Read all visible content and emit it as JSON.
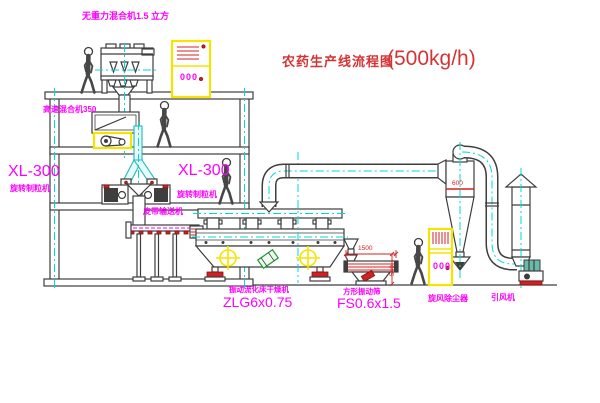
{
  "title": {
    "name": "农药生产线流程图",
    "capacity": "(500kg/h)"
  },
  "equipment_labels": {
    "gravity_free_mixer": "无重力混合机1.5 立方",
    "high_speed_mixer": "高速混合机350",
    "granulator_model": "XL-300",
    "granulator_name": "旋转制粒机",
    "belt_conveyor": "皮带输送机",
    "fluid_bed_dryer_name": "振动流化床干燥机",
    "fluid_bed_dryer_model": "ZLG6x0.75",
    "vibrating_sieve_name": "方形振动筛",
    "vibrating_sieve_model": "FS0.6x1.5",
    "cyclone_dust_collector": "旋风除尘器",
    "induced_draft_fan": "引风机"
  },
  "dimensions": {
    "cyclone_width": "600",
    "sieve_length": "1500",
    "sieve_height": "540"
  },
  "control_cabinet": {
    "display": "000"
  },
  "colors": {
    "label_magenta": "#ff00ff",
    "title_red": "#d43434",
    "line_dark": "#3e3e3e",
    "centerline_cyan": "#00d8d8",
    "accent_yellow": "#f5e400",
    "accent_red": "#cc2222",
    "accent_green": "#1f9a3a"
  }
}
